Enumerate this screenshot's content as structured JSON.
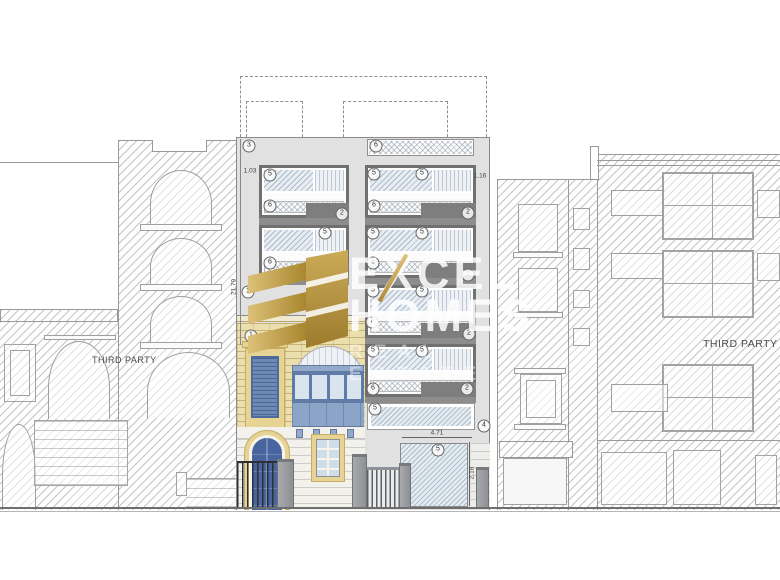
{
  "drawing": {
    "type": "architectural street elevation",
    "labels": {
      "left_party": "THIRD PARTY",
      "right_party": "THIRD PARTY"
    },
    "watermark": {
      "brand_line1": "EXCEL",
      "brand_line2": "HOMES",
      "brand_line3": "REAL ESTATE"
    },
    "dimensions": [
      {
        "text": "1.03",
        "x": 250,
        "y": 171,
        "rot": 0
      },
      {
        "text": "1.16",
        "x": 480,
        "y": 176,
        "rot": 0
      },
      {
        "text": "21.79",
        "x": 234,
        "y": 287,
        "rot": -90
      },
      {
        "text": "4.71",
        "x": 437,
        "y": 433,
        "rot": 0
      },
      {
        "text": "2.18",
        "x": 472,
        "y": 473,
        "rot": -90
      }
    ],
    "callouts": [
      {
        "n": "3",
        "x": 249,
        "y": 146
      },
      {
        "n": "6",
        "x": 376,
        "y": 146
      },
      {
        "n": "5",
        "x": 270,
        "y": 175
      },
      {
        "n": "5",
        "x": 374,
        "y": 174
      },
      {
        "n": "5",
        "x": 422,
        "y": 174
      },
      {
        "n": "6",
        "x": 270,
        "y": 206
      },
      {
        "n": "6",
        "x": 374,
        "y": 206
      },
      {
        "n": "2",
        "x": 342,
        "y": 214
      },
      {
        "n": "2",
        "x": 468,
        "y": 213
      },
      {
        "n": "5",
        "x": 325,
        "y": 233
      },
      {
        "n": "5",
        "x": 373,
        "y": 233
      },
      {
        "n": "5",
        "x": 422,
        "y": 233
      },
      {
        "n": "6",
        "x": 270,
        "y": 263
      },
      {
        "n": "6",
        "x": 373,
        "y": 263
      },
      {
        "n": "2",
        "x": 341,
        "y": 274
      },
      {
        "n": "2",
        "x": 468,
        "y": 275
      },
      {
        "n": "5",
        "x": 373,
        "y": 291
      },
      {
        "n": "5",
        "x": 422,
        "y": 291
      },
      {
        "n": "7",
        "x": 372,
        "y": 322
      },
      {
        "n": "2",
        "x": 469,
        "y": 334
      },
      {
        "n": "1",
        "x": 248,
        "y": 292
      },
      {
        "n": "1",
        "x": 251,
        "y": 336
      },
      {
        "n": "5",
        "x": 373,
        "y": 351
      },
      {
        "n": "5",
        "x": 422,
        "y": 351
      },
      {
        "n": "6",
        "x": 373,
        "y": 389
      },
      {
        "n": "2",
        "x": 467,
        "y": 389
      },
      {
        "n": "5",
        "x": 375,
        "y": 409
      },
      {
        "n": "4",
        "x": 484,
        "y": 426
      },
      {
        "n": "5",
        "x": 438,
        "y": 450
      }
    ],
    "colors": {
      "logo_gold": "#c3a053",
      "facade_gray": "#e1e1e1",
      "window_frame_gray": "#707070",
      "limestone": "#ecdfae",
      "surround_yellow": "#e7d494",
      "balcony_blue": "#8ba4c7",
      "door_blue": "#49659f",
      "watermark_white": "#ffffff"
    }
  }
}
